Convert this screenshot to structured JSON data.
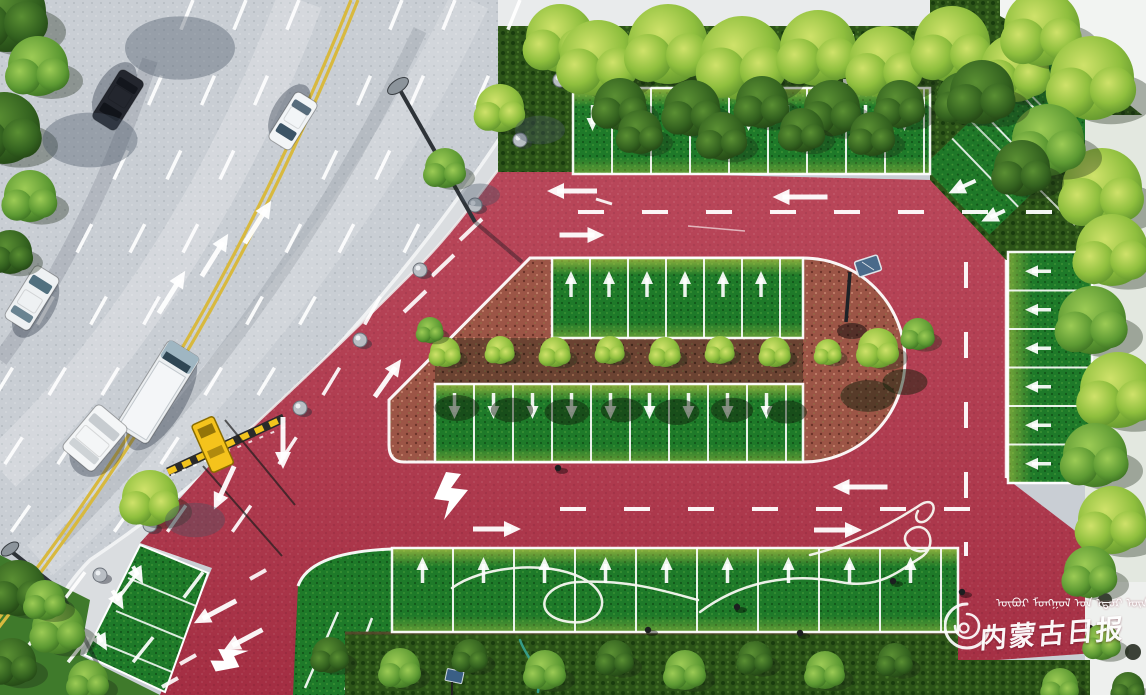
{
  "image": {
    "type": "aerial-drone-photograph",
    "subject": "Newly built color-paved eco parking lot with grass parking stalls, red resin roadway loop, barrier gate entrance, beside an urban avenue with traffic",
    "width": 1146,
    "height": 695
  },
  "watermark": {
    "logo": "spiral-brush-logo",
    "mongolian": "ᠥᠪᠥᠷ ᠮᠣᠩᠭᠣᠯ ᠤᠨ ᠡᠳᠦᠷ ᠦᠨ ᠰᠣᠨᠢᠨ",
    "chinese": "内蒙古日报",
    "translation": "Inner Mongolia Daily",
    "text_color": "#ffffff"
  },
  "palette": {
    "red_pavement": "#b23449",
    "asphalt": "#c9ced4",
    "sidewalk": "#dadde0",
    "grass_stall": "#1e7a29",
    "grass_worn_yellow": "#c2c84a",
    "hedge_dark": "#2c5318",
    "mulch_brown": "#6b4332",
    "mulch_pink": "#9c5546",
    "lane_yellow": "#d8b93e",
    "marking_white": "#ffffff",
    "barrier_yellow": "#f2c41d"
  },
  "scene": {
    "road": {
      "center_line": "double-yellow",
      "lane_marks": "dashed-white",
      "direction_arrows": 3
    },
    "equipment": [
      "barrier-gate",
      "speed-bump-strip",
      "street-lamps",
      "solar-street-lamp",
      "stone-bollards",
      "garden-hoses",
      "solar-panel",
      "sign-board"
    ],
    "people_note": "workers watering new grass stalls",
    "parking_rows": [
      {
        "id": "top-row",
        "x": 573,
        "y": 88,
        "w": 357,
        "h": 86,
        "stall": 39,
        "dir": "down",
        "arrowOff": 56
      },
      {
        "id": "island-top-row",
        "x": 552,
        "y": 258,
        "w": 251,
        "h": 80,
        "stall": 38,
        "dir": "up",
        "arrowOff": 26
      },
      {
        "id": "island-bottom-row",
        "x": 435,
        "y": 384,
        "w": 368,
        "h": 78,
        "stall": 39,
        "dir": "down",
        "arrowOff": 56
      },
      {
        "id": "bottom-row",
        "x": 392,
        "y": 548,
        "w": 566,
        "h": 84,
        "stall": 61,
        "dir": "up",
        "arrowOff": 22
      },
      {
        "id": "right-column",
        "x": 1008,
        "y": 252,
        "w": 84,
        "h": 231,
        "stall": 38.5,
        "dir": "left",
        "arrowOff": 20
      }
    ],
    "trees": [
      [
        6,
        12,
        40,
        "d"
      ],
      [
        38,
        66,
        30,
        "m"
      ],
      [
        4,
        128,
        36,
        "d"
      ],
      [
        30,
        196,
        26,
        "m"
      ],
      [
        10,
        252,
        22,
        "d"
      ],
      [
        180,
        48,
        44,
        "s"
      ],
      [
        90,
        140,
        38,
        "s"
      ],
      [
        560,
        38,
        34,
        "b"
      ],
      [
        500,
        108,
        24,
        "b"
      ],
      [
        445,
        168,
        20,
        "m"
      ],
      [
        150,
        498,
        28,
        "b"
      ],
      [
        598,
        64,
        26,
        "s"
      ],
      [
        540,
        130,
        20,
        "s"
      ],
      [
        480,
        195,
        16,
        "s"
      ],
      [
        195,
        520,
        24,
        "s"
      ],
      [
        598,
        58,
        38,
        "b"
      ],
      [
        668,
        44,
        40,
        "b"
      ],
      [
        742,
        58,
        42,
        "b"
      ],
      [
        818,
        48,
        38,
        "b"
      ],
      [
        885,
        62,
        36,
        "b"
      ],
      [
        952,
        44,
        38,
        "b"
      ],
      [
        1015,
        68,
        34,
        "b"
      ],
      [
        620,
        104,
        26,
        "d"
      ],
      [
        692,
        108,
        28,
        "d"
      ],
      [
        762,
        102,
        26,
        "d"
      ],
      [
        832,
        108,
        28,
        "d"
      ],
      [
        900,
        104,
        24,
        "d"
      ],
      [
        963,
        98,
        26,
        "d"
      ],
      [
        640,
        132,
        22,
        "d"
      ],
      [
        722,
        136,
        24,
        "d"
      ],
      [
        802,
        130,
        22,
        "d"
      ],
      [
        872,
        134,
        22,
        "d"
      ],
      [
        1042,
        28,
        38,
        "b"
      ],
      [
        1092,
        78,
        42,
        "b"
      ],
      [
        1102,
        188,
        40,
        "b"
      ],
      [
        1048,
        140,
        36,
        "m"
      ],
      [
        982,
        92,
        32,
        "d"
      ],
      [
        1022,
        168,
        28,
        "d"
      ],
      [
        1112,
        250,
        36,
        "b"
      ],
      [
        1092,
        320,
        34,
        "m"
      ],
      [
        1118,
        390,
        38,
        "b"
      ],
      [
        1095,
        455,
        32,
        "m"
      ],
      [
        1112,
        520,
        34,
        "b"
      ],
      [
        1090,
        572,
        26,
        "m"
      ],
      [
        445,
        352,
        15,
        "b"
      ],
      [
        500,
        350,
        14,
        "b"
      ],
      [
        555,
        352,
        15,
        "b"
      ],
      [
        610,
        350,
        14,
        "b"
      ],
      [
        665,
        352,
        15,
        "b"
      ],
      [
        720,
        350,
        14,
        "b"
      ],
      [
        775,
        352,
        15,
        "b"
      ],
      [
        828,
        352,
        13,
        "b"
      ],
      [
        457,
        408,
        18,
        "g"
      ],
      [
        512,
        410,
        17,
        "g"
      ],
      [
        567,
        412,
        18,
        "g"
      ],
      [
        622,
        410,
        17,
        "g"
      ],
      [
        677,
        412,
        18,
        "g"
      ],
      [
        732,
        410,
        17,
        "g"
      ],
      [
        787,
        412,
        16,
        "g"
      ],
      [
        878,
        348,
        20,
        "b"
      ],
      [
        918,
        334,
        16,
        "m"
      ],
      [
        868,
        396,
        22,
        "g"
      ],
      [
        905,
        382,
        18,
        "g"
      ],
      [
        430,
        330,
        13,
        "m"
      ],
      [
        330,
        655,
        18,
        "d"
      ],
      [
        400,
        668,
        20,
        "m"
      ],
      [
        470,
        656,
        17,
        "d"
      ],
      [
        545,
        670,
        20,
        "m"
      ],
      [
        615,
        658,
        18,
        "d"
      ],
      [
        685,
        670,
        20,
        "m"
      ],
      [
        755,
        658,
        17,
        "d"
      ],
      [
        825,
        670,
        19,
        "m"
      ],
      [
        895,
        660,
        17,
        "d"
      ],
      [
        18,
        588,
        28,
        "d"
      ],
      [
        58,
        628,
        26,
        "m"
      ],
      [
        12,
        662,
        24,
        "d"
      ],
      [
        88,
        680,
        20,
        "m"
      ],
      [
        45,
        600,
        20,
        "m"
      ],
      [
        1102,
        642,
        18,
        "m"
      ],
      [
        1128,
        688,
        16,
        "d"
      ],
      [
        1060,
        686,
        18,
        "m"
      ]
    ],
    "bollards": [
      [
        560,
        80
      ],
      [
        520,
        140
      ],
      [
        475,
        205
      ],
      [
        420,
        270
      ],
      [
        360,
        340
      ],
      [
        300,
        408
      ],
      [
        150,
        525
      ],
      [
        100,
        575
      ],
      [
        70,
        625
      ]
    ],
    "road_arrows": [
      [
        215,
        255,
        50,
        32
      ],
      [
        258,
        222,
        50,
        32
      ],
      [
        172,
        292,
        50,
        32
      ],
      [
        800,
        197,
        55,
        270
      ],
      [
        572,
        191,
        50,
        270
      ],
      [
        582,
        235,
        45,
        90
      ],
      [
        860,
        487,
        55,
        270
      ],
      [
        838,
        530,
        48,
        90
      ],
      [
        497,
        529,
        48,
        90
      ],
      [
        388,
        378,
        46,
        35
      ],
      [
        283,
        443,
        52,
        180
      ],
      [
        224,
        488,
        48,
        205
      ],
      [
        215,
        612,
        48,
        242
      ],
      [
        243,
        640,
        44,
        242
      ],
      [
        962,
        187,
        30,
        245
      ],
      [
        993,
        216,
        26,
        245
      ],
      [
        118,
        600,
        22,
        150
      ],
      [
        102,
        642,
        20,
        150
      ],
      [
        138,
        575,
        20,
        150
      ]
    ],
    "vehicles": [
      {
        "type": "suv",
        "x": 118,
        "y": 100,
        "w": 28,
        "h": 58,
        "rot": 212,
        "body": "#23262e",
        "glass": "#11141a"
      },
      {
        "type": "sedan",
        "x": 293,
        "y": 121,
        "w": 26,
        "h": 56,
        "rot": 212,
        "body": "#f2f5f7",
        "glass": "#3c5466"
      },
      {
        "type": "minivan",
        "x": 32,
        "y": 298,
        "w": 29,
        "h": 62,
        "rot": 32,
        "body": "#eef1f3",
        "glass": "#51707f"
      },
      {
        "type": "box-truck",
        "x": 158,
        "y": 392,
        "w": 37,
        "h": 102,
        "rot": 32,
        "body": "#eceff1",
        "glass": "#2f4654"
      },
      {
        "type": "parked-white",
        "x": 95,
        "y": 438,
        "w": 40,
        "h": 58,
        "rot": 40,
        "body": "#f4f6f7",
        "glass": "#c7ccd0"
      }
    ],
    "workers": [
      [
        558,
        468
      ],
      [
        737,
        607
      ],
      [
        893,
        581
      ],
      [
        800,
        633
      ],
      [
        962,
        592
      ],
      [
        648,
        630
      ],
      [
        1090,
        628
      ],
      [
        1093,
        648
      ]
    ]
  }
}
